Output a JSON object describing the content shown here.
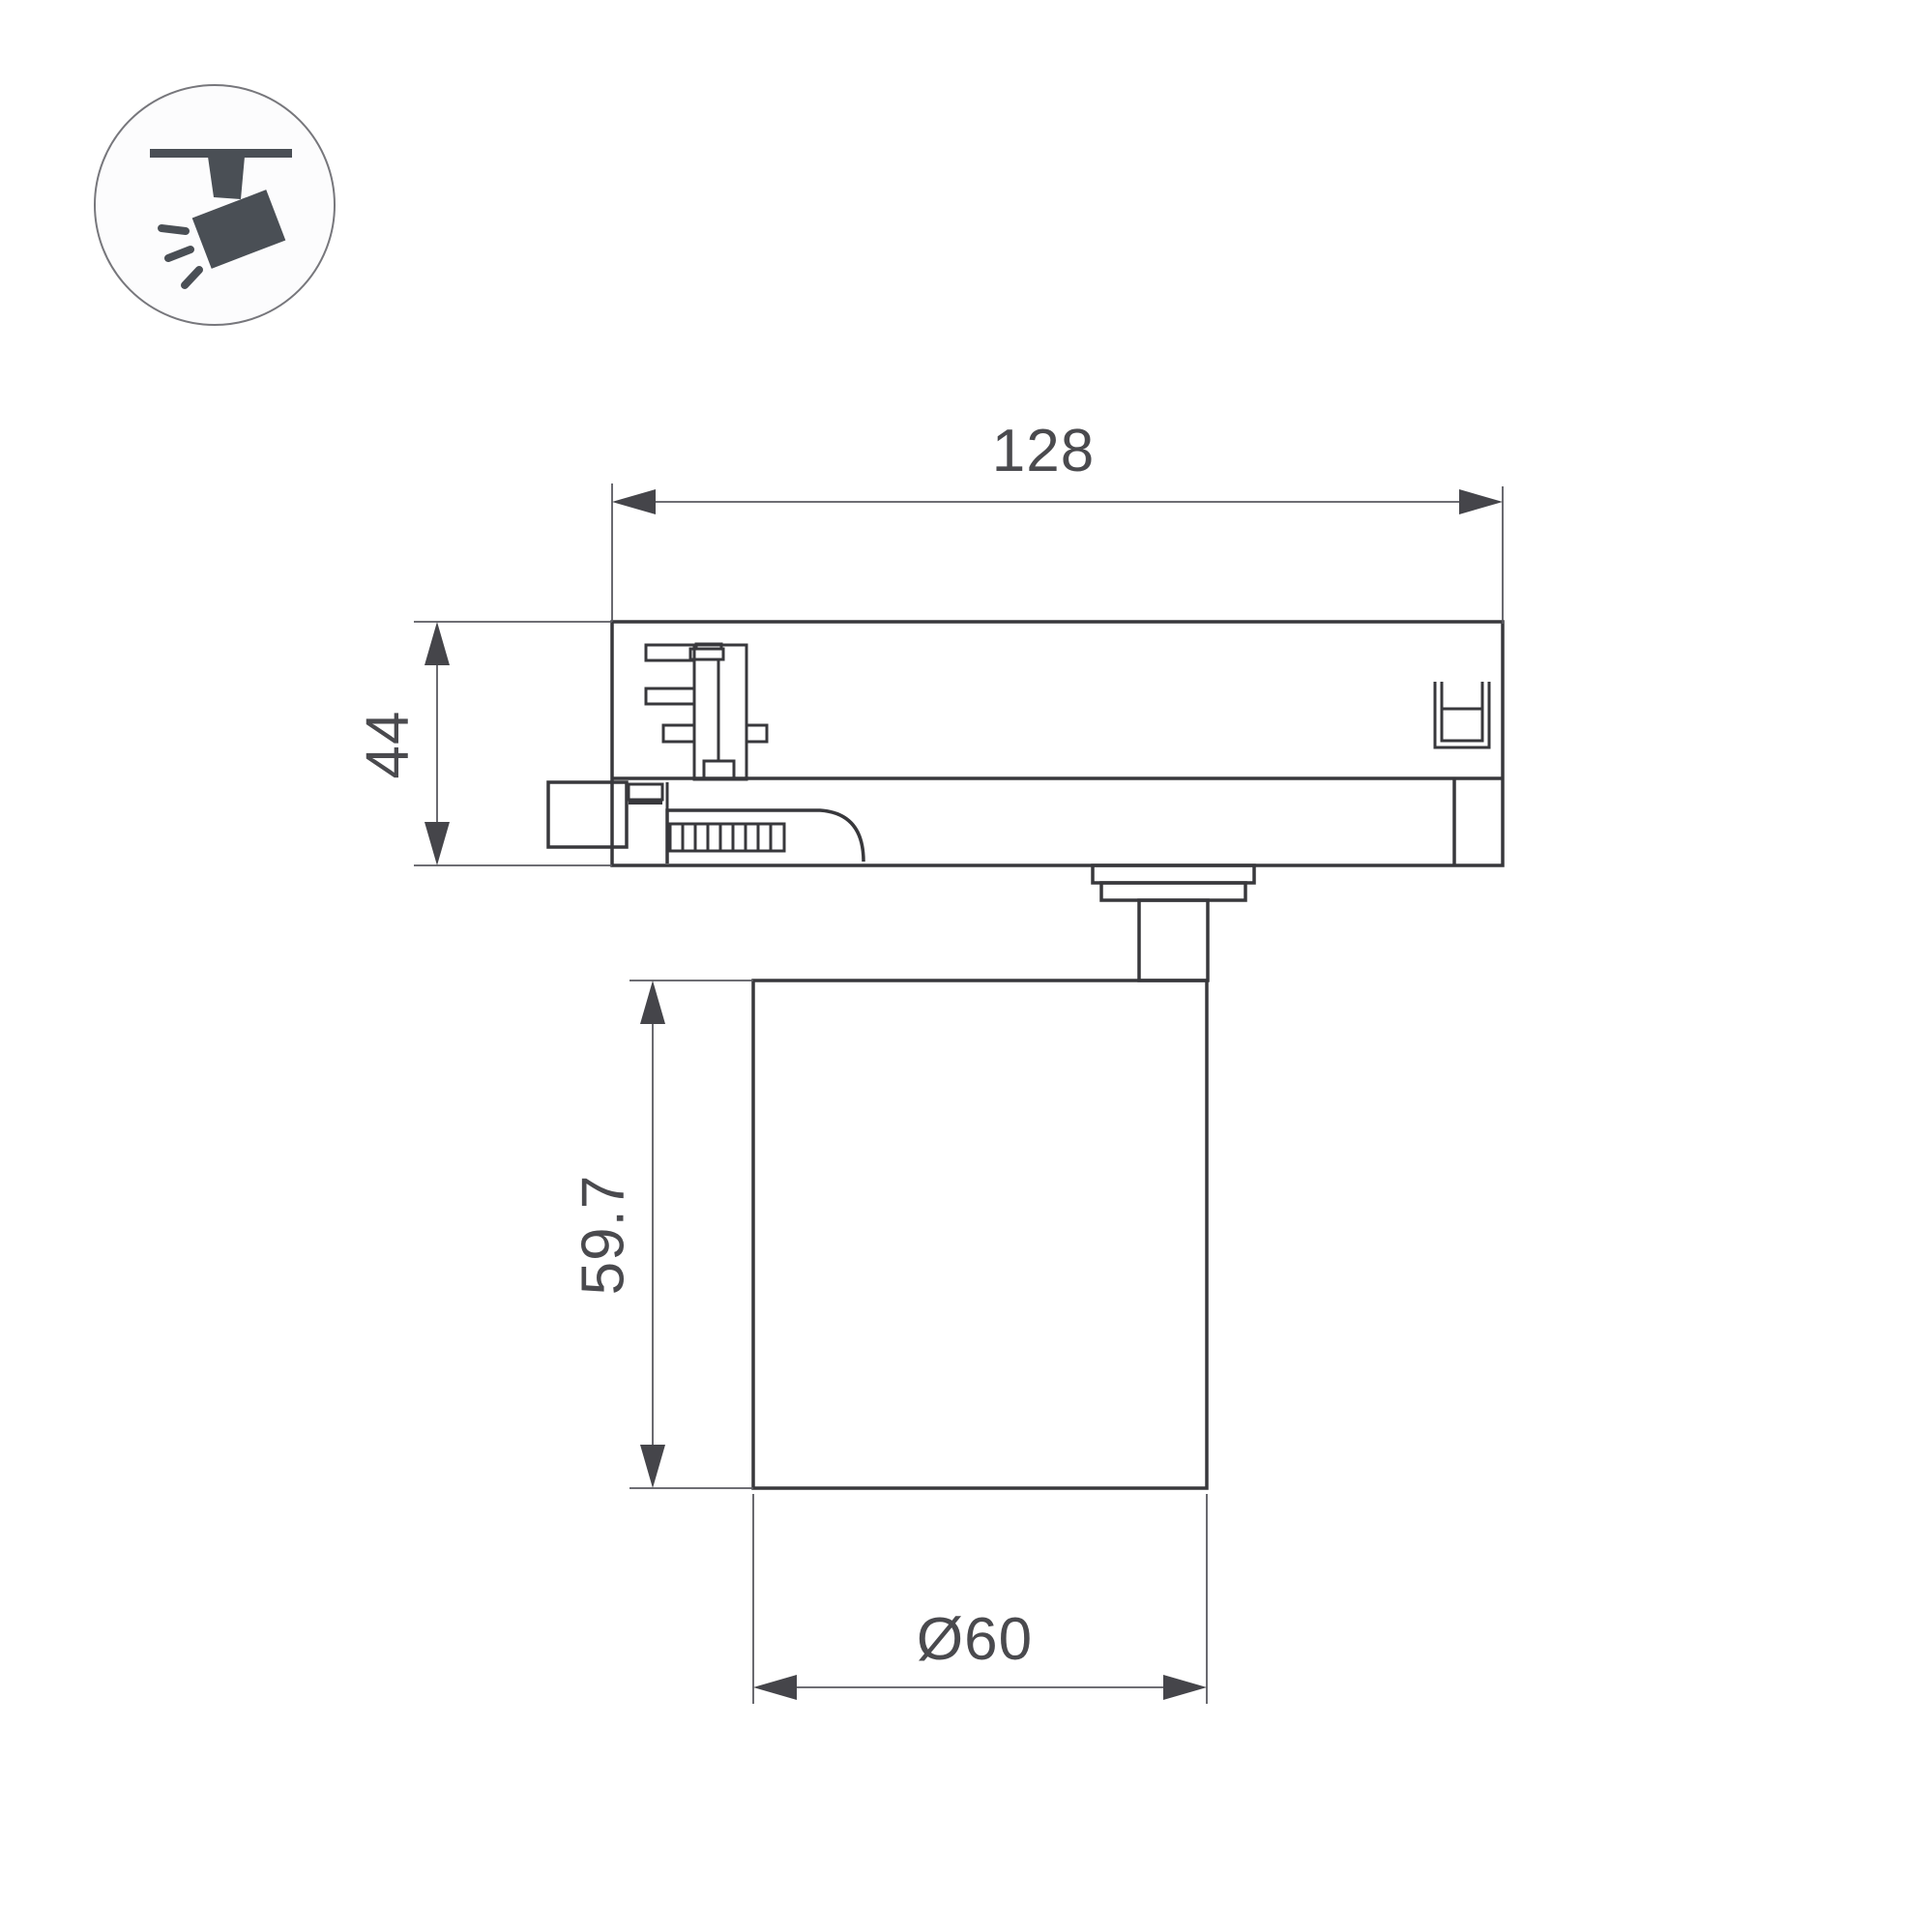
{
  "page": {
    "background": "#ffffff"
  },
  "icon": {
    "name": "track-spotlight-icon",
    "glyph_color": "#4a4f55",
    "circle_stroke": "#77777c"
  },
  "drawing": {
    "type": "technical-dimension-drawing",
    "outline_color": "#38383c",
    "dimension_line_color": "#5a5a60",
    "text_color": "#4a4a4e",
    "dimensions": {
      "adapter_width": "128",
      "adapter_height": "44",
      "body_height": "59.7",
      "body_diameter": "Ø60"
    }
  }
}
